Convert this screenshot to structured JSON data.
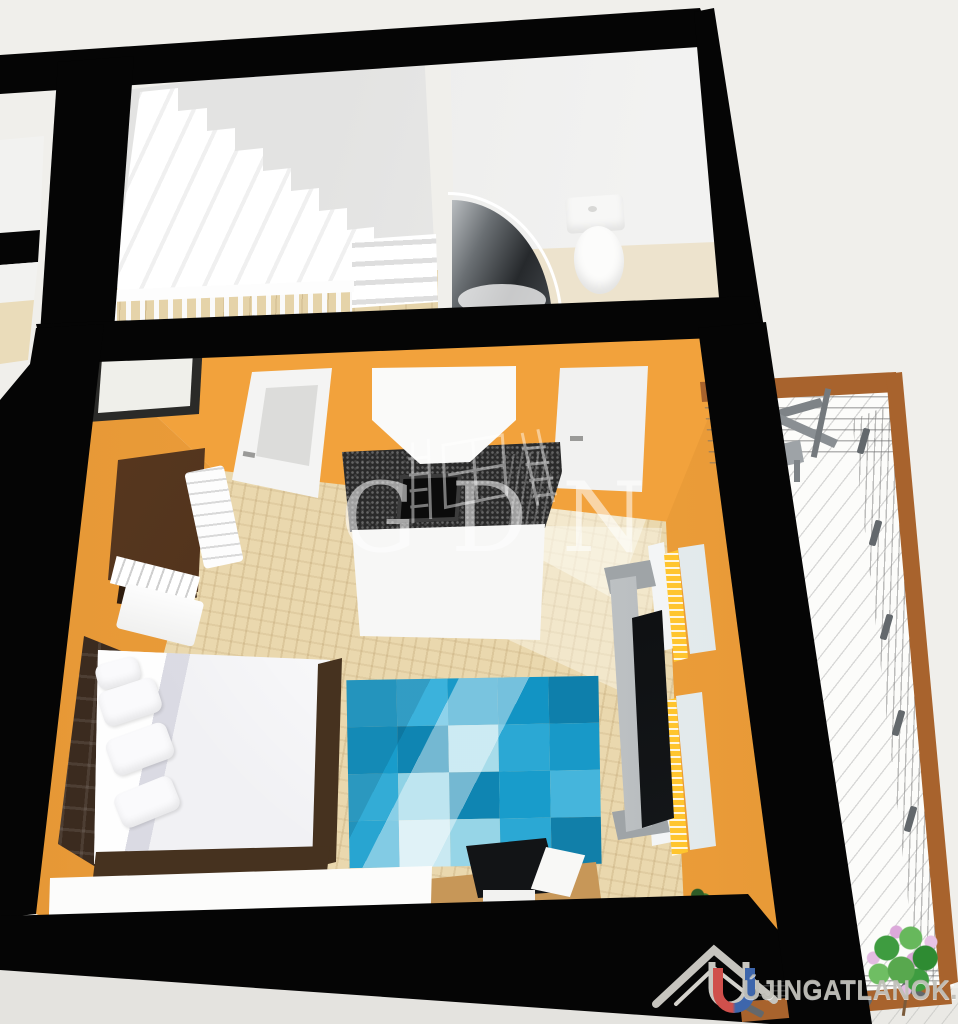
{
  "watermarks": {
    "center_text": "GDN",
    "corner_text": "ÚJINGATLANOK.HU"
  },
  "colors": {
    "background": "#F0EFEB",
    "wall_black": "#050505",
    "wall_orange": "#F2A23C",
    "floor_parquet": "#EAD8AE",
    "counter_granite": "#2A2A2A",
    "headboard_brown": "#3B2B1F",
    "bedding_white": "#F1F1F4",
    "radiator_yellow": "#FFC52E",
    "desk_wood": "#C79758",
    "balcony_rail_brown": "#A8632D",
    "balcony_floor": "#FCFCFA",
    "railing_gray": "#63686C",
    "watermark_white": "rgba(255,255,255,0.55)",
    "logo_red": "#D0504C",
    "logo_blue": "#3E66AC",
    "logo_gray": "#C2C0BA",
    "rug_blue": "#18A0CE",
    "rug_blue_dark": "#0E82B0",
    "rug_blue_light": "#9BD8E9",
    "plant_green": "#3E9C40",
    "plant_flower_pink": "#DCA9DA"
  },
  "rug": {
    "cells": [
      "#2BA8D4",
      "#3BB2DC",
      "#1899C8",
      "#1294C4",
      "#0E7FAB",
      "#189CCB",
      "#0F85B2",
      "#A7DCEA",
      "#2BA8D4",
      "#1899C8",
      "#33ACD6",
      "#8FD2E5",
      "#0F85B2",
      "#189CCB",
      "#45B5DC",
      "#28A5D1",
      "#C9E9F2",
      "#96D5E7",
      "#2BA8D4",
      "#117FA9"
    ]
  }
}
